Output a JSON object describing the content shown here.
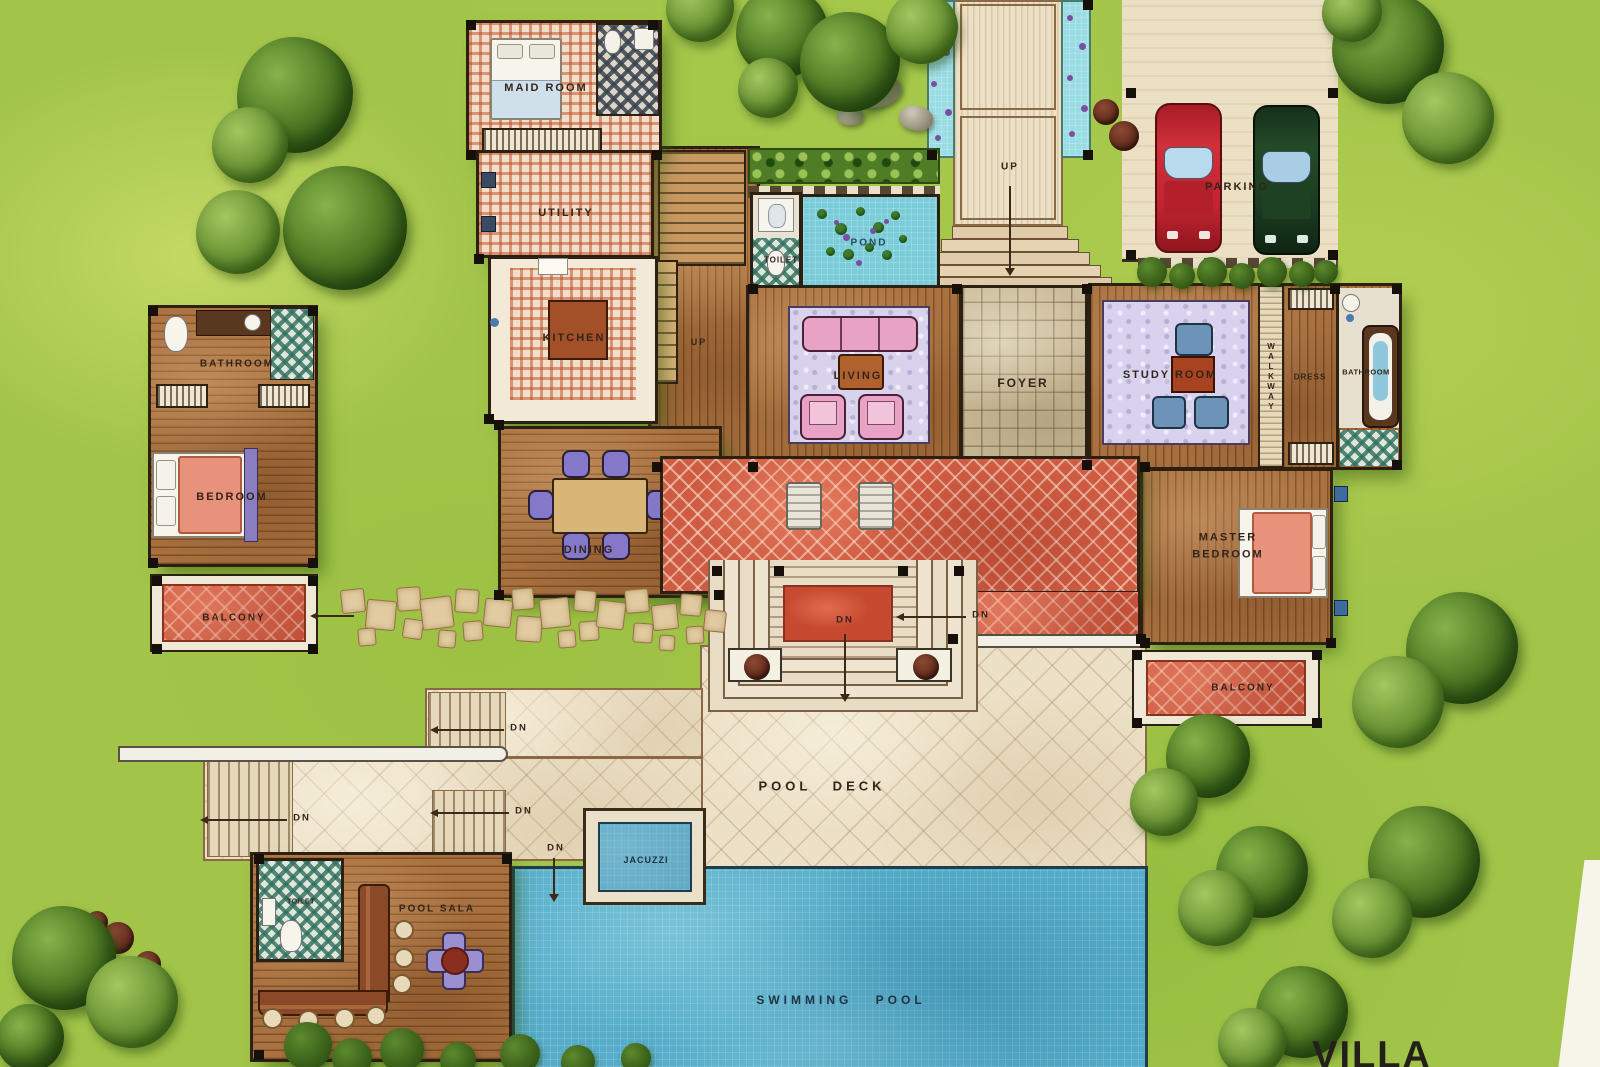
{
  "title": {
    "villa": "VILLA"
  },
  "rooms": {
    "maid_room": "MAID ROOM",
    "utility": "UTILITY",
    "kitchen": "KITCHEN",
    "toilet_main": "TOILET",
    "pond": "POND",
    "living": "LIVING",
    "foyer": "FOYER",
    "study_room": "STUDY ROOM",
    "walkway": "WALKWAY",
    "dress": "DRESS",
    "bathroom_right": "BATHROOM",
    "master_bedroom": "MASTER BEDROOM",
    "balcony_right": "BALCONY",
    "dining": "DINING",
    "bathroom_left": "BATHROOM",
    "bedroom_left": "BEDROOM",
    "balcony_left": "BALCONY",
    "parking": "PARKING",
    "pool_deck": "POOL DECK",
    "jacuzzi": "JACUZZI",
    "swimming_pool": "SWIMMING POOL",
    "pool_sala": "POOL SALA",
    "toilet_sala": "TOILET"
  },
  "markers": {
    "up": "UP",
    "dn": "DN"
  },
  "colors": {
    "grass": "#a2c449",
    "wood": "#a9713f",
    "terrace_red": "#cf5c42",
    "pool_blue": "#55adc9",
    "stone": "#cbbc9b",
    "cream_deck": "#ece0c6",
    "car_red": "#c02430",
    "car_green": "#1b3a20",
    "label_ink": "#33241a"
  }
}
